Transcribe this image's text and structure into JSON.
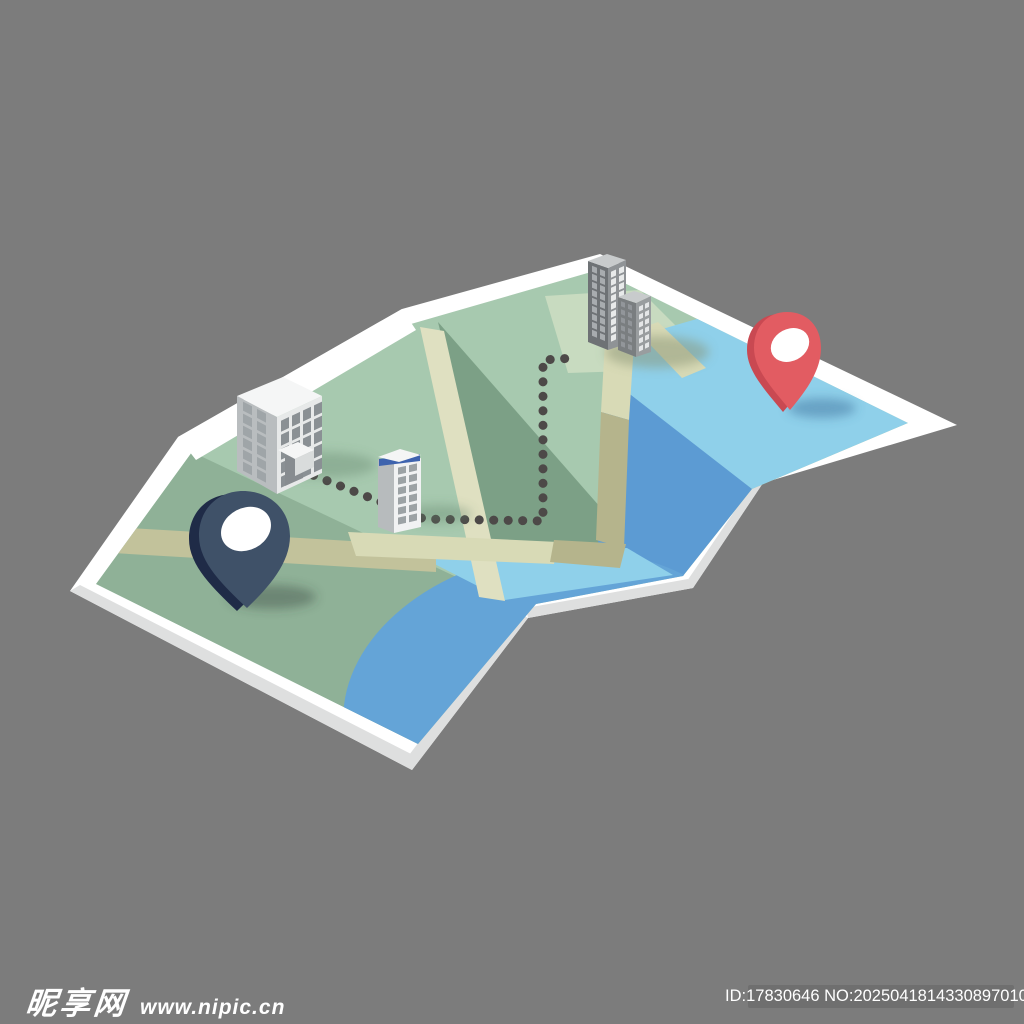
{
  "page": {
    "width": 1024,
    "height": 1024,
    "background": "#7C7C7C"
  },
  "watermark": {
    "site_name": "昵享网",
    "site_url": "www.nipic.cn",
    "color": "#FFFFFF"
  },
  "id_badge": {
    "label": "ID:17830646 NO:20250418143308970101",
    "background": "#6F6F6F",
    "color": "#FFFFFF"
  },
  "illustration": {
    "description": "isometric folded paper map with dotted route between a navy start pin and a red destination pin, three building groups, roads and water",
    "palette": {
      "paper": "#FFFFFF",
      "paper_edge": "#DEDFDF",
      "land_light": "#A7C9AF",
      "land_mid": "#8FB197",
      "land_lawn": "#C8DBC0",
      "land_shaded": "#7CA086",
      "water_light": "#8FD0EA",
      "water_mid": "#64A4D7",
      "water_dark": "#5C9BD3",
      "road_light": "#DFE0C1",
      "road_cream": "#D8DAB6",
      "road_mid": "#C2C29B",
      "road_olive": "#B5B48C",
      "bld_front": "#E7E9E9",
      "bld_side": "#B9BDBF",
      "bld_roof": "#F5F6F6",
      "bld_window": "#8A9094",
      "bld_window_side": "#9FA5A8",
      "canopy_front": "#D9DCDC",
      "door": "#878C90",
      "tower_front": "#F1F2F3",
      "tower_side": "#B7BBBD",
      "tower_roof": "#F4F5F5",
      "tower_roof_band": "#3E63AE",
      "tower_window": "#9CA2A5",
      "twin_front": "#8F9396",
      "twin_side": "#6E7275",
      "twin_roof": "#C8CBCC",
      "twin_window": "#E8EAEA",
      "twin_window_side": "#A8ACAF",
      "short_front": "#999D9F",
      "short_side": "#7A7E80",
      "short_window": "#E4E6E7",
      "short_window_side": "#92969A"
    },
    "pins": [
      {
        "name": "start-pin",
        "color": "#3F5168",
        "rim": "#1F2B47",
        "hole": "#FFFFFF"
      },
      {
        "name": "destination-pin",
        "color": "#E25C62",
        "rim": "#C94952",
        "hole": "#FFFFFF"
      }
    ],
    "buildings": [
      {
        "name": "office-block",
        "floors": 5
      },
      {
        "name": "small-tower",
        "floors": 6
      },
      {
        "name": "twin-towers",
        "floors": 10
      }
    ],
    "route": {
      "style": "dotted",
      "color": "#4D4948"
    }
  }
}
